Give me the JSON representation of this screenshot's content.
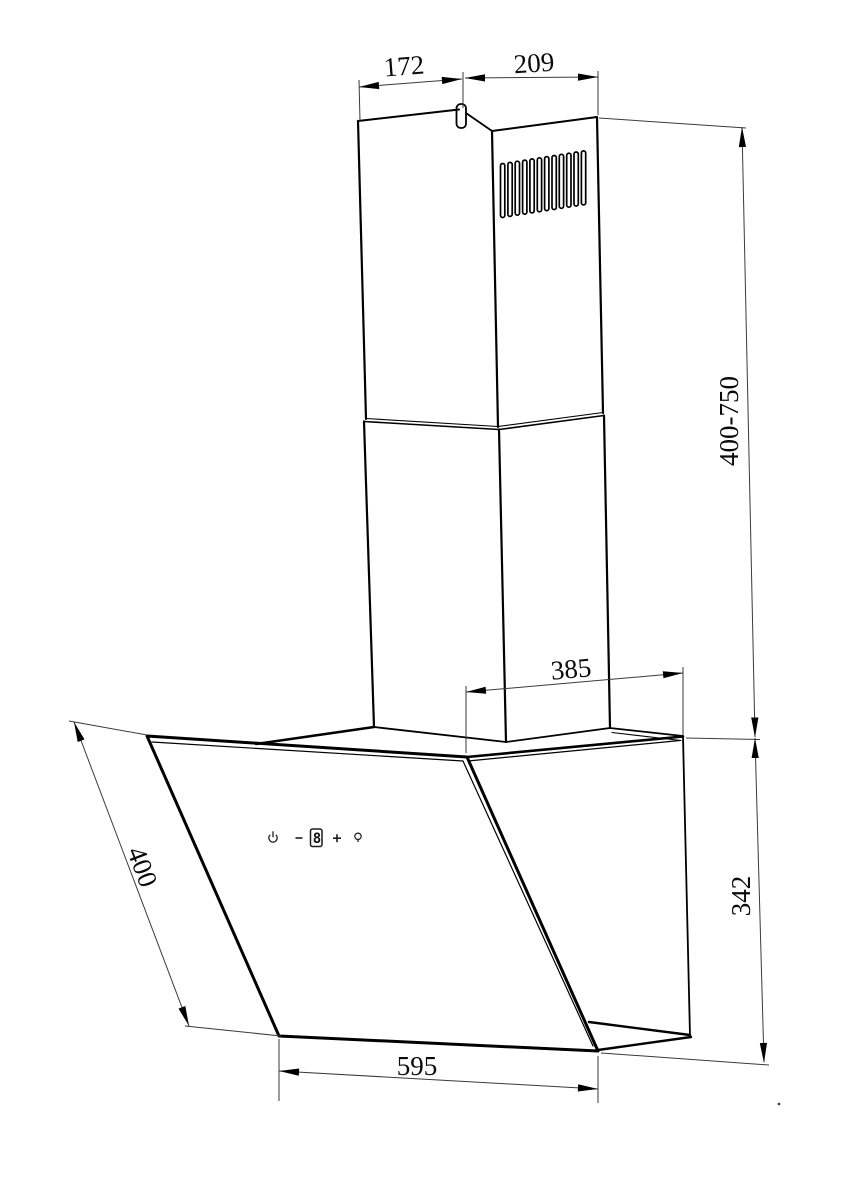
{
  "drawing": {
    "subject": "wall-mounted angled cooker hood with telescopic chimney - dimensioned line drawing",
    "dimensions": {
      "chimney_top_left_width": "172",
      "chimney_top_right_width": "209",
      "chimney_height_range": "400-750",
      "hood_top_depth": "385",
      "body_height": "342",
      "body_width": "595",
      "glass_panel_length": "400"
    },
    "control_panel": {
      "display_value": "8",
      "buttons": [
        "power",
        "minus",
        "speed-display",
        "plus",
        "light"
      ]
    }
  }
}
